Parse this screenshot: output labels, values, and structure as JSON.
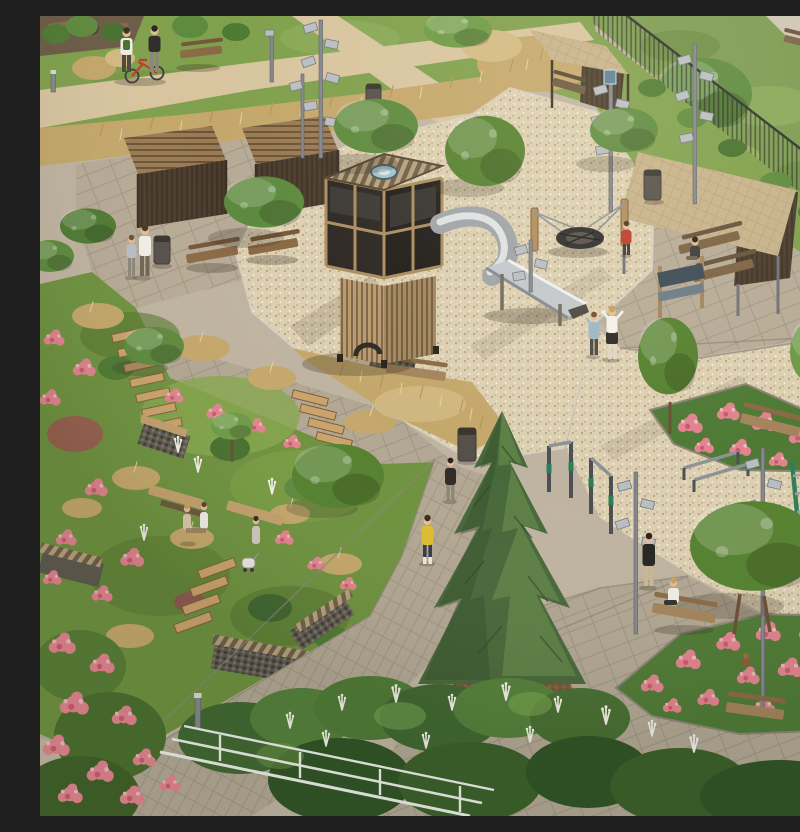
{
  "meta": {
    "title": "Aerial 3D architectural render — landscaped residential park with playground",
    "description": "Bird's-eye daytime visualization of a courtyard park: a gravel playground with a timber cube play-tower and steel tube slide, a rope nest swing, timber pergolas and shelters with benches, a terraced hillside garden with wooden steps, gabion walls and pink flower drifts, a large spruce, outdoor fitness bars, paved walking paths, multi-head lamp posts, a mesh boundary fence with meadow beyond, and people strolling, cycling and sitting."
  },
  "palette": {
    "paving_base": "#bfb4a1",
    "plaza_gray": "#b2a794",
    "walkway_gray": "#b7ab97",
    "path_tan": "#d8c5a0",
    "lawn_green": "#7fa04c",
    "meadow_green": "#7c9b52",
    "garden_green": "#6e923f",
    "dry_grass": "#c4a76b",
    "gravel_beige": "#dccfb2",
    "spruce_green": "#47683a",
    "canopy_green": "#5d8a3e",
    "flower_pink": "#e2838f",
    "flower_deep_pink": "#c75a6c",
    "wood_light": "#c2a06c",
    "wood_mid": "#8a6a45",
    "wood_dark": "#5a4633",
    "glass_dark": "#2b2622",
    "roof_tan": "#c7b28a",
    "slide_steel": "#c3c7cb",
    "metal_gray": "#84878b",
    "fence_dark": "#2f332b",
    "bin_gray": "#55504a",
    "equipment_green": "#2e7d56",
    "railing_white": "#eceee9",
    "mulch_brown": "#7a5b3c",
    "bike_red": "#c23a2f",
    "shirt_yellow": "#e0bd2e",
    "shirt_red": "#c0392b"
  },
  "scene": {
    "areas": [
      {
        "name": "lawn-top-left",
        "desc": "Green lawns crossed by tan pedestrian paths"
      },
      {
        "name": "ornamental-grass-band",
        "desc": "Diagonal drift of dry golden ornamental grasses"
      },
      {
        "name": "gravel-playground",
        "desc": "Beige gravel play area around tower, slide and nest swing"
      },
      {
        "name": "terraced-garden",
        "desc": "Sloped garden with timber steps, gabion walls, benches and pink planting"
      },
      {
        "name": "fitness-area",
        "desc": "Gravel zone with green-gripped pull-up bars, parallel bars and wall bars"
      },
      {
        "name": "seating-plaza",
        "desc": "Paved plaza with benches and hydrangea beds, lower right"
      },
      {
        "name": "meadow-beyond-fence",
        "desc": "Wild meadow and tree outside the mesh boundary fence, top right"
      },
      {
        "name": "foreground-shrubs",
        "desc": "Dense shrubs, white plume grasses and a white railing at the bottom edge"
      }
    ],
    "structures": [
      {
        "name": "play-tower",
        "desc": "Timber cube tower with dark glazed cabin, striped roof, skylight and slatted base"
      },
      {
        "name": "tube-slide",
        "desc": "Stainless steel tube slide curving from the tower into an open chute"
      },
      {
        "name": "nest-swing",
        "desc": "Round rope nest swing hung between two timber posts"
      },
      {
        "name": "pergolas",
        "desc": "Two slatted timber pergola shelters on the left plaza"
      },
      {
        "name": "shelters",
        "desc": "Two flat-roofed timber shelters with benches (top and right)"
      },
      {
        "name": "sign-board",
        "desc": "Small timber-framed information sign by the right shelter"
      },
      {
        "name": "mesh-fence",
        "desc": "Dark metal mesh fence running diagonally across the top right"
      },
      {
        "name": "white-railing",
        "desc": "White metal railing at the bottom foreground"
      },
      {
        "name": "gabion-walls",
        "desc": "Stone gabion retaining walls with timber bench tops"
      },
      {
        "name": "timber-steps",
        "desc": "Flights of wooden steps descending the terraced garden"
      }
    ],
    "equipment": [
      {
        "name": "pull-up-bars",
        "desc": "Row of steel pull-up bars with green grips"
      },
      {
        "name": "parallel-bars",
        "desc": "Low parallel bars on the gravel"
      },
      {
        "name": "wall-bars",
        "desc": "Green ladder wall bars at the right edge"
      }
    ],
    "furniture": {
      "benches": 12,
      "lamp_posts": 8,
      "litter_bins": 4,
      "bollard_lights": 2
    },
    "vegetation": [
      {
        "name": "spruce",
        "desc": "Large conical spruce in a mulch planter, center bottom"
      },
      {
        "name": "deciduous-trees",
        "desc": "About a dozen young broadleaf trees across the park"
      },
      {
        "name": "hydrangea-beds",
        "desc": "Pink flower beds lower right, right and bottom left"
      },
      {
        "name": "dry-grasses",
        "desc": "Golden ornamental grass drifts"
      },
      {
        "name": "white-plume-grass",
        "desc": "White-plumed grasses along the bottom"
      }
    ],
    "people": [
      {
        "id": "cyclists",
        "desc": "Two people walking a red bicycle on the upper path",
        "location": "top left"
      },
      {
        "id": "man-with-child",
        "desc": "Man in white shirt with a small child at the litter bin",
        "location": "left, near pergolas"
      },
      {
        "id": "child-red",
        "desc": "Child in red top beside the nest swing",
        "location": "playground"
      },
      {
        "id": "woman-and-child",
        "desc": "Woman in white top playing with a child in blue",
        "location": "playground gravel"
      },
      {
        "id": "woman-shelter",
        "desc": "Woman seated on a bench under the right shelter",
        "location": "right shelter"
      },
      {
        "id": "women-terrace",
        "desc": "Three women seated on terrace benches with a pram",
        "location": "terraced garden"
      },
      {
        "id": "boy-yellow",
        "desc": "Boy in a yellow T-shirt walking down the path",
        "location": "center path"
      },
      {
        "id": "child-dark",
        "desc": "Child in dark top further up the same path",
        "location": "center path"
      },
      {
        "id": "woman-phone",
        "desc": "Woman in dark jacket standing on the gravel",
        "location": "lower right"
      },
      {
        "id": "woman-bench",
        "desc": "Woman in white top seated on a bench",
        "location": "lower right"
      }
    ],
    "counts": {
      "people": 14,
      "trees_large": 12,
      "flower_beds": 3,
      "shelters": 4
    }
  }
}
